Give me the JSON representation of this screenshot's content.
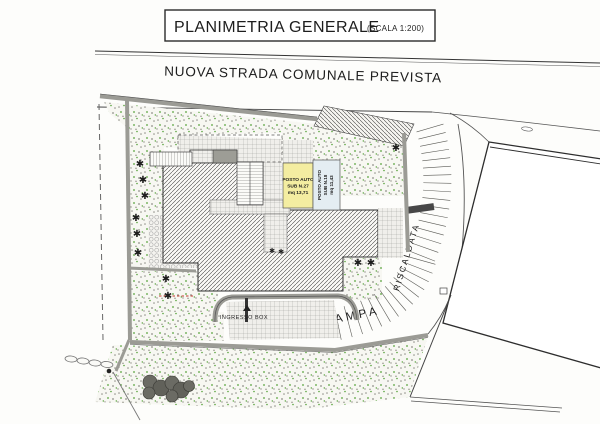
{
  "title": {
    "main": "PLANIMETRIA GENERALE",
    "scale": "(SCALA 1:200)"
  },
  "road": {
    "label": "NUOVA STRADA COMUNALE PREVISTA"
  },
  "parking_stalls": [
    {
      "label_lines": [
        "POSTO AUTO",
        "SUB N.27",
        "mq 13,71"
      ],
      "fill": "#f4eda1"
    },
    {
      "label_lines": [
        "POSTO AUTO",
        "SUB N.18",
        "mq 11,43"
      ],
      "fill": "#e4edf2"
    }
  ],
  "labels": {
    "ingresso_box": "INGRESSO BOX",
    "rampa": "RAMPA",
    "riscaldata": "RISCALDATA"
  },
  "icons": {
    "tree_glyph": "✱"
  },
  "colors": {
    "paper": "#fdfdfb",
    "vegetation_green": "#57a33b",
    "hatch_line": "#3e3e3e",
    "wall_gray": "#9b9b95",
    "stall_yellow": "#f4eda1",
    "stall_blue": "#e4edf2"
  }
}
